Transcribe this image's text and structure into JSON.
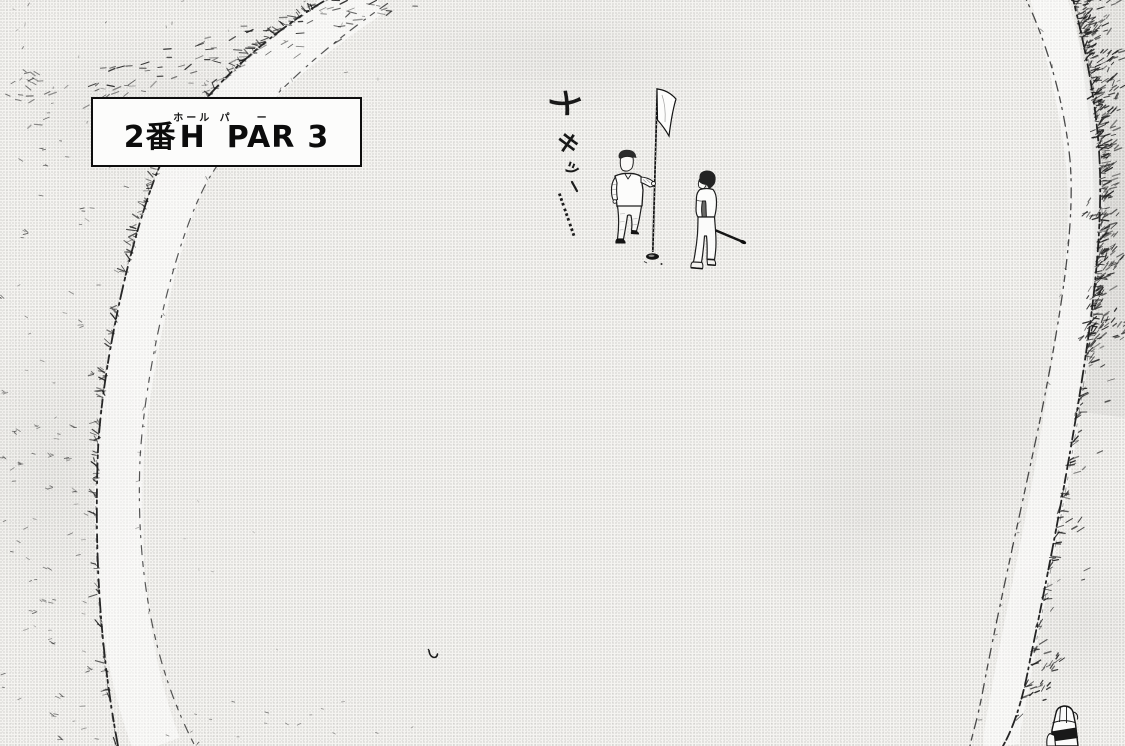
{
  "sign": {
    "parts": [
      {
        "text": "2番",
        "ruby": ""
      },
      {
        "text": "H",
        "ruby": "ホール"
      },
      {
        "text": "PAR",
        "ruby": "パー"
      },
      {
        "text": "3",
        "ruby": ""
      }
    ]
  },
  "sfx": {
    "chars": [
      "メ",
      "キ",
      "ッ"
    ],
    "trail": "………"
  },
  "colors": {
    "ink": "#1c1c1c",
    "paper": "#f5f4f1",
    "sign_background": "#fcfcfb"
  }
}
